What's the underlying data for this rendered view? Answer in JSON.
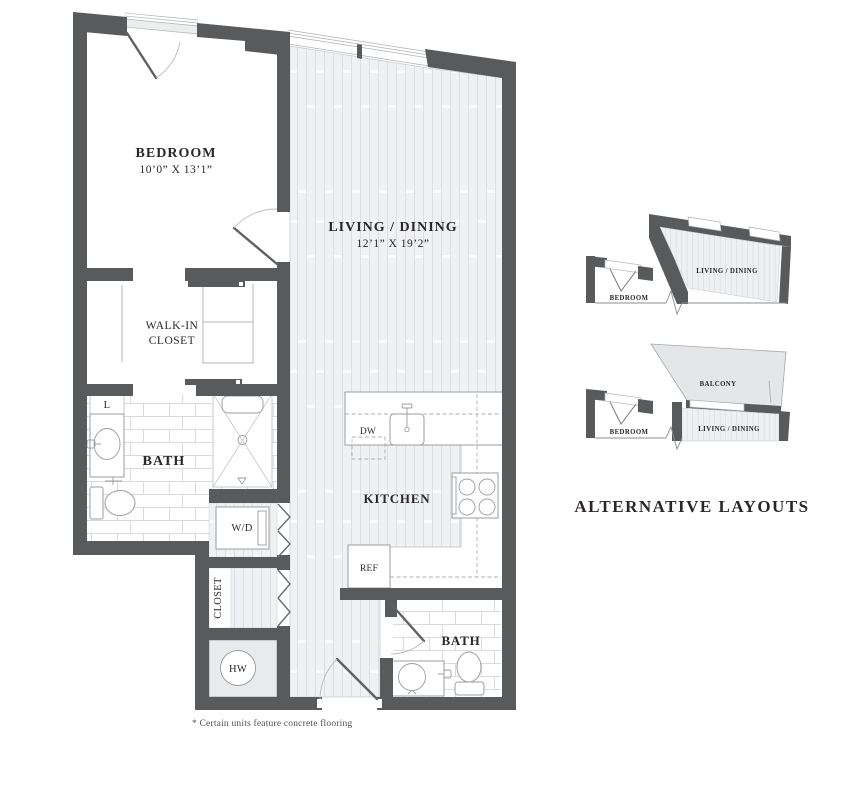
{
  "floor_plan": {
    "rooms": {
      "bedroom": {
        "name": "BEDROOM",
        "dimensions": "10’0” X 13’1”"
      },
      "living_dining": {
        "name": "LIVING / DINING",
        "dimensions": "12’1” X 19’2”"
      },
      "walk_in_closet": {
        "line1": "WALK-IN",
        "line2": "CLOSET"
      },
      "bath_main": {
        "name": "BATH"
      },
      "kitchen": {
        "name": "KITCHEN"
      },
      "bath_second": {
        "name": "BATH"
      },
      "closet": {
        "name": "CLOSET"
      }
    },
    "fixtures": {
      "washer_dryer": "W/D",
      "water_heater": "HW",
      "linen": "L",
      "dishwasher": "DW",
      "refrigerator": "REF"
    },
    "footnote": "* Certain units feature concrete flooring"
  },
  "alternative_layouts": {
    "title": "ALTERNATIVE LAYOUTS",
    "layout1": {
      "living_dining": "LIVING / DINING",
      "bedroom": "BEDROOM"
    },
    "layout2": {
      "balcony": "BALCONY",
      "living_dining": "LIVING / DINING",
      "bedroom": "BEDROOM"
    }
  },
  "colors": {
    "wall": "#595a5c",
    "plank_line": "#dadce0",
    "tile_line": "#d9dbde",
    "balcony_fill": "#e4e6e8",
    "text": "#2b2728"
  }
}
